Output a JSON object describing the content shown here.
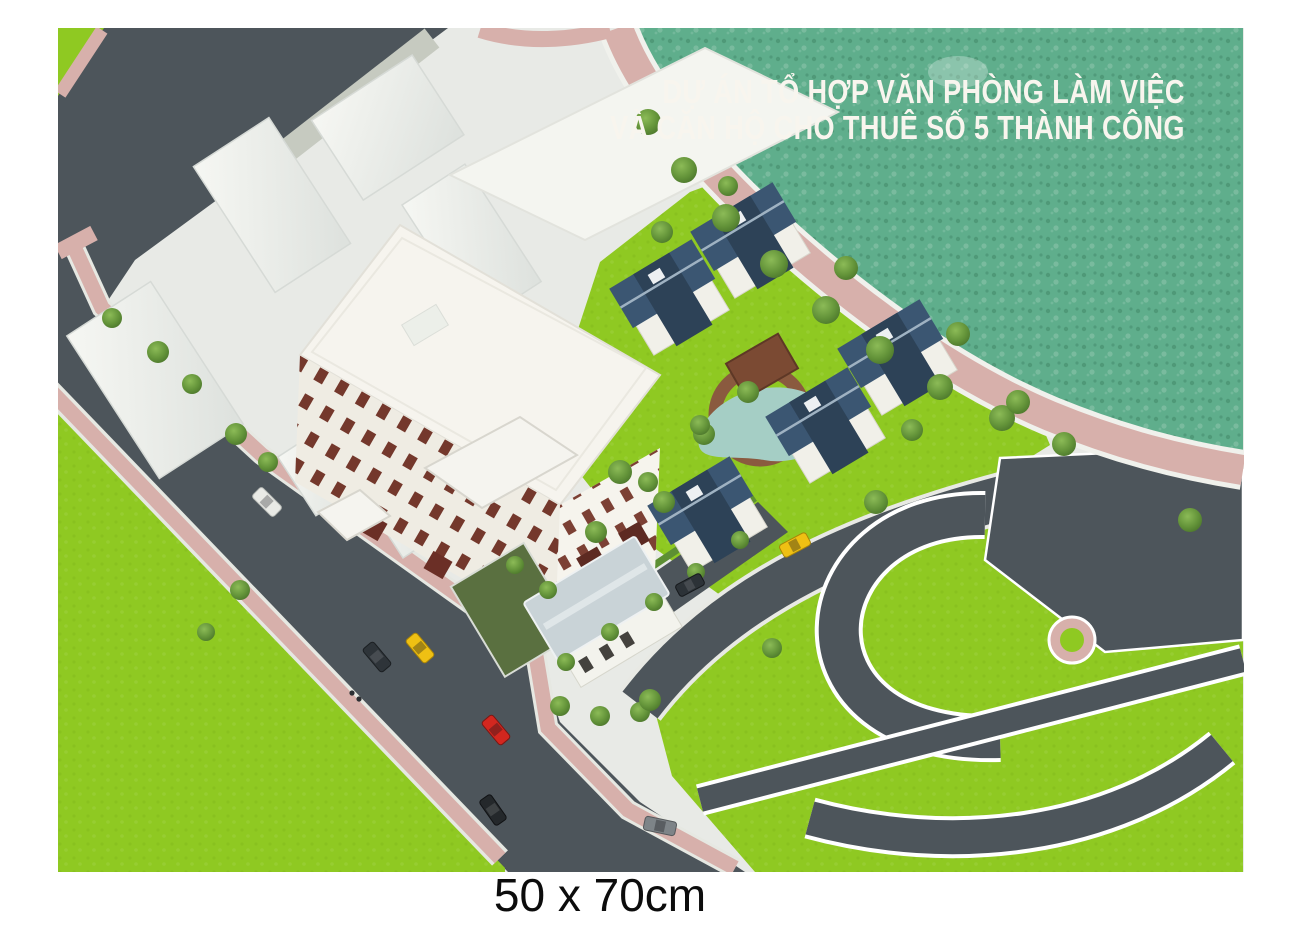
{
  "artwork": {
    "title_line1": "DỰ ÁN TỔ HỢP VĂN PHÒNG LÀM VIỆC",
    "title_line2": "VÀ CĂN HỘ CHO THUÊ SỐ 5 THÀNH CÔNG",
    "size_caption": "50 x 70cm"
  },
  "colors": {
    "page_background": "#ffffff",
    "plaza_ground": "#e8eae6",
    "water": "#5fae8c",
    "lawn": "#8fc922",
    "road": "#4d555b",
    "sidewalk_pink": "#d7b0ab",
    "path_brown": "#8a5a3f",
    "building_white": "#f6f4ee",
    "villa_roof_blue": "#3b5672",
    "pavilion_roof_gray": "#c9d3d7",
    "window_brown": "#74382c",
    "title_text": "#f8f5ee",
    "caption_text": "#0c0c0c",
    "car_red": "#d3271f",
    "car_yellow": "#efc013"
  }
}
